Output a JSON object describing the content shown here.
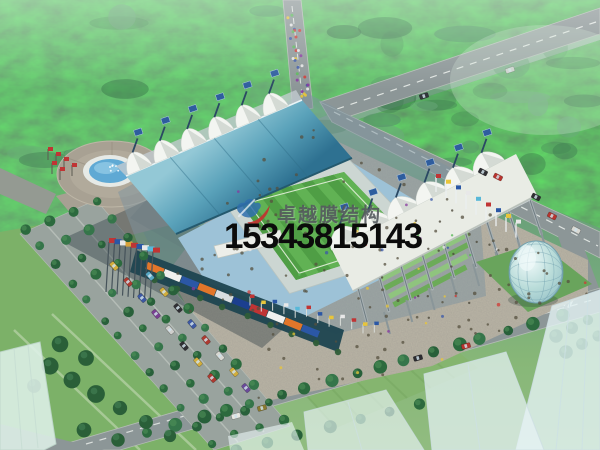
{
  "watermark": {
    "company_name": "卓越膜结构",
    "phone": "15343815143",
    "logo_icon": "swoosh-bird-logo-icon",
    "company_text_color": "#52575c",
    "phone_text_color": "#0b0b0b"
  },
  "palette": {
    "logo_red": "#c23430",
    "logo_blue": "#2f6fae",
    "forest_green": "#4a8a5c",
    "lawn_green": "#7cb168",
    "pitch_green": "#56a84a",
    "stadium_roof_teal": "#57a0b8",
    "membrane_white": "#f3f5f1",
    "grandstand_seats_blue": "#9dc2d7",
    "road_gray": "#8c9697",
    "plaza_pavement": "#b8b3a4",
    "glass_dome": "#a8cdd2"
  }
}
